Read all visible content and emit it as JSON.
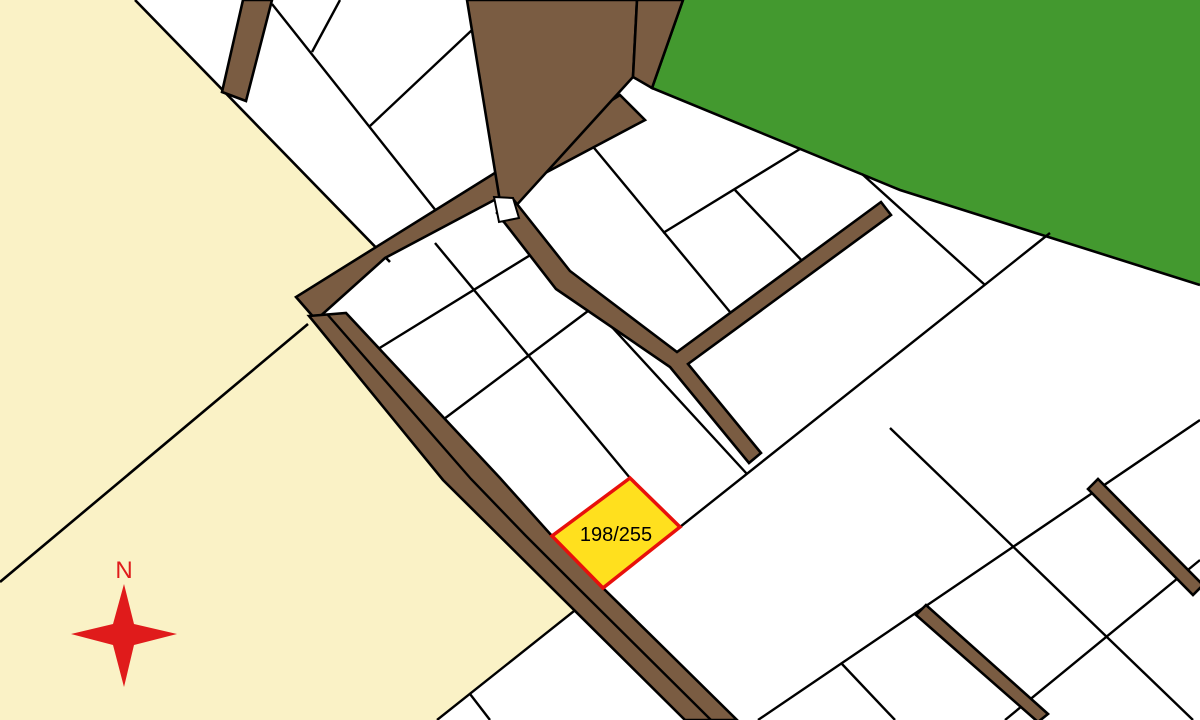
{
  "map": {
    "highlighted_parcel": {
      "label": "198/255",
      "fill": "#FFE01E",
      "stroke": "#E8100C"
    },
    "compass": {
      "label": "N",
      "color": "#E01B1B"
    },
    "colors": {
      "background": "#FFFFFF",
      "field": "#FAF2C6",
      "forest": "#43992F",
      "road": "#7A5C42",
      "parcel_fill": "#FFFFFF",
      "line": "#000000"
    }
  }
}
